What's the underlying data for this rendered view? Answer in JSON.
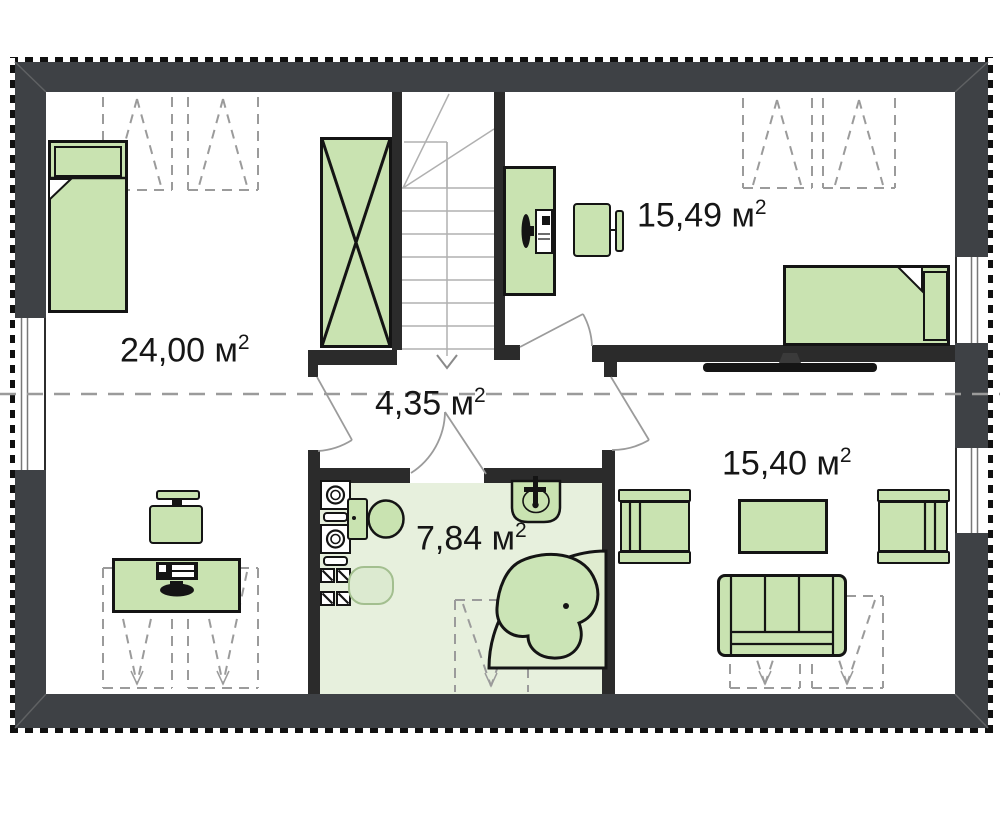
{
  "title": "attic-floor-plan",
  "rooms": [
    {
      "id": "bedroom-left",
      "label": "24,00 м",
      "sup": "2"
    },
    {
      "id": "bedroom-right",
      "label": "15,49 м",
      "sup": "2"
    },
    {
      "id": "hall",
      "label": "4,35 м",
      "sup": "2"
    },
    {
      "id": "bathroom",
      "label": "7,84 м",
      "sup": "2"
    },
    {
      "id": "living-room",
      "label": "15,40 м",
      "sup": "2"
    }
  ],
  "colors": {
    "exterior-wall": "#3e4145",
    "interior-wall": "#2b2b2b",
    "furniture-green": "#c9e3b1",
    "bathroom-floor": "#e7f0dd",
    "bathtub-fill": "#dfeccf",
    "dashed-line-gray": "#9b9b9b"
  },
  "fixtures": [
    "single-bed",
    "wardrobe",
    "staircase",
    "desk",
    "computer",
    "office-chair",
    "roof-window",
    "door-swing",
    "window",
    "washing-machine",
    "toilet",
    "sink",
    "corner-bathtub",
    "armchair",
    "coffee-table",
    "sofa",
    "tv"
  ]
}
